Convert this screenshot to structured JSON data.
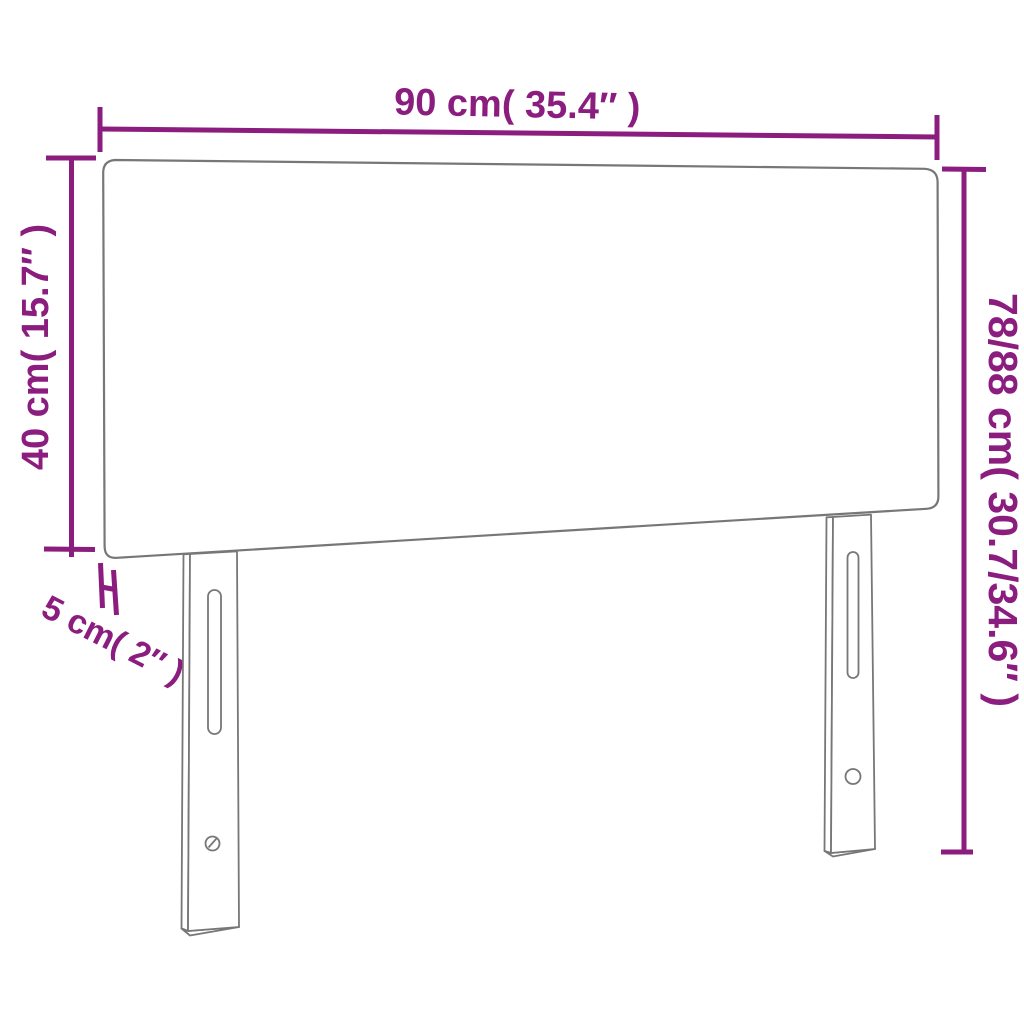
{
  "diagram": {
    "colors": {
      "dimension_accent": "#8B1D7F",
      "outline_gray": "#777777",
      "background": "#FFFFFF"
    },
    "labels": {
      "width": "90 cm( 35.4″ )",
      "height_left": "40 cm( 15.7″ )",
      "height_right": "78/88 cm( 30.7/34.6″ )",
      "thickness": "5 cm( 2″ )"
    }
  }
}
